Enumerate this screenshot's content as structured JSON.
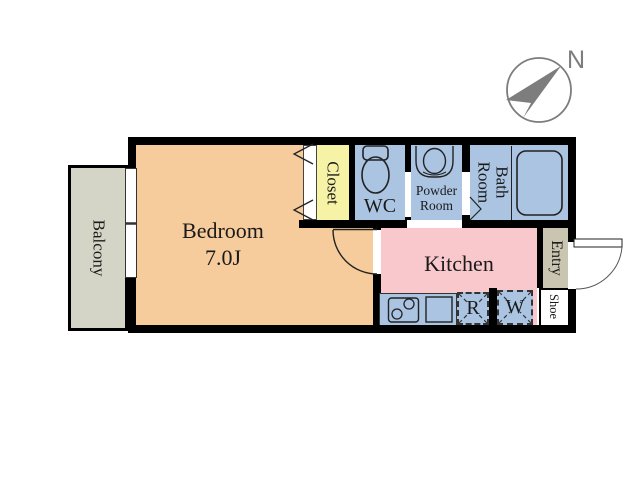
{
  "compass": {
    "north_label": "N"
  },
  "rooms": {
    "balcony": "Balcony",
    "bedroom": "Bedroom",
    "bedroom_size": "7.0J",
    "closet": "Closet",
    "wc": "WC",
    "powder_room": "Powder Room",
    "bath_room": "Bath Room",
    "kitchen": "Kitchen",
    "entry": "Entry",
    "shoe": "Shoe",
    "refrigerator": "R",
    "washer": "W"
  },
  "colors": {
    "bedroom": "#f6cc9c",
    "kitchen": "#f8c8cc",
    "wet_area": "#aac4e2",
    "closet": "#f7f3a6",
    "balcony": "#d5d5c7",
    "entry": "#cac5b1",
    "wall": "#000000",
    "compass": "#7d7d7d",
    "line": "#222222"
  },
  "icons": {
    "compass": "compass-north-arrow-icon",
    "toilet": "toilet-icon",
    "washbasin": "washbasin-icon",
    "bathtub": "bathtub-icon",
    "stove": "stove-burners-icon",
    "kitchen_sink": "kitchen-sink-icon",
    "doors": "door-swing-arc",
    "closet_doors": "folding-door-chevrons",
    "window": "sliding-window"
  }
}
